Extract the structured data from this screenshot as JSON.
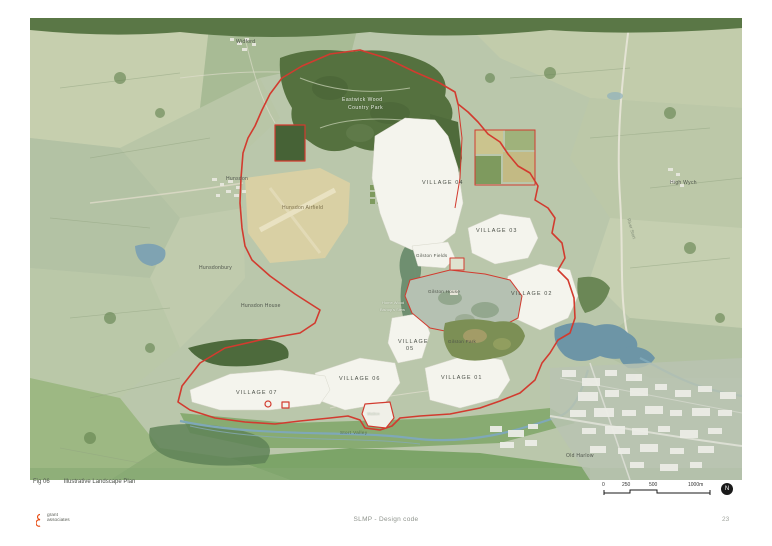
{
  "page": {
    "figure_label": "Fig 06",
    "figure_title": "Illustrative Landscape Plan",
    "footer_center": "SLMP - Design code",
    "page_number": "23",
    "logo": {
      "line1": "grant",
      "line2": "associates"
    }
  },
  "scalebar": {
    "ticks": [
      "0",
      "250",
      "500",
      "1000m"
    ],
    "north": "N"
  },
  "colors": {
    "boundary_red": "#d23b2f",
    "village_fill": "#f4f4ed",
    "water_blue": "#6d95a6",
    "map_base": "#bac7ab",
    "wood_dark": "#55713f",
    "airfield_tan": "#d9d0a4",
    "logo_orange": "#e8490f"
  },
  "map": {
    "labels": [
      {
        "text": "Widford"
      },
      {
        "text": "Hunsdon"
      },
      {
        "text": "High Wych"
      },
      {
        "text": "Hunsdon Airfield"
      },
      {
        "text": "Hunsdonbury"
      },
      {
        "text": "Hunsdon House"
      },
      {
        "text": "Eastwick Wood"
      },
      {
        "text": "Country Park"
      },
      {
        "text": "VILLAGE 04"
      },
      {
        "text": "VILLAGE 03"
      },
      {
        "text": "VILLAGE 02"
      },
      {
        "text": "Gilston Fields"
      },
      {
        "text": "Gilston House"
      },
      {
        "text": "Home Wood"
      },
      {
        "text": "Bishop's Stew"
      },
      {
        "text": "VILLAGE"
      },
      {
        "text": "05"
      },
      {
        "text": "Gilston Park"
      },
      {
        "text": "VILLAGE 06"
      },
      {
        "text": "VILLAGE 01"
      },
      {
        "text": "VILLAGE 07"
      },
      {
        "text": "Station"
      },
      {
        "text": "Stort Valley"
      },
      {
        "text": "Old Harlow"
      },
      {
        "text": "River Stort"
      }
    ]
  }
}
